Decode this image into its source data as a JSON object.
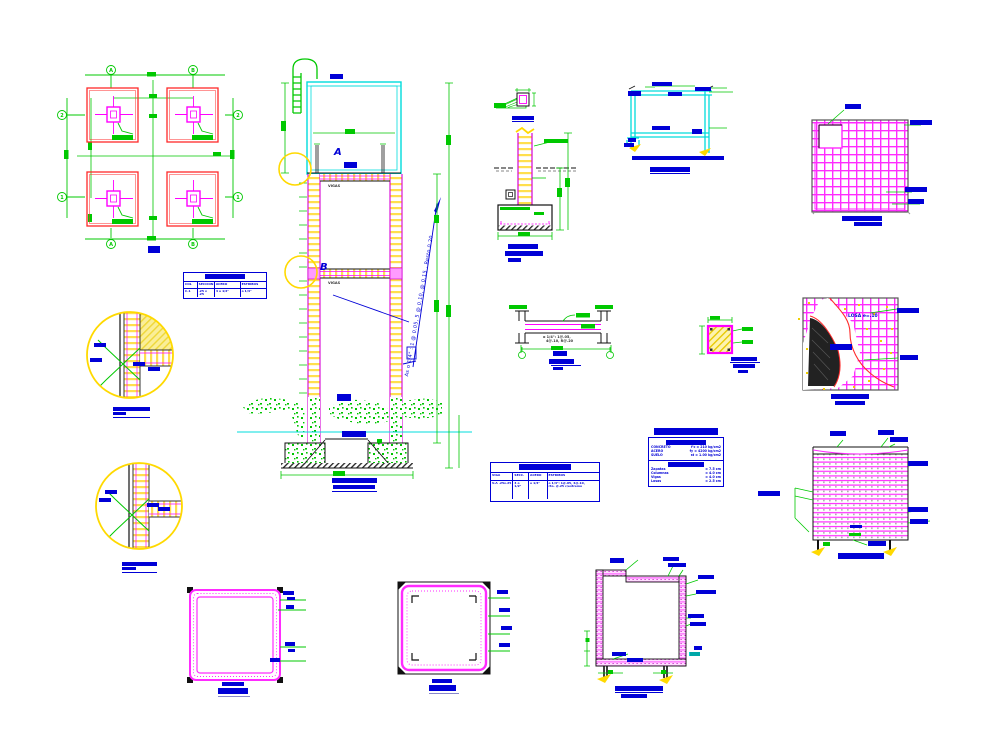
{
  "colors": {
    "green": "#00c800",
    "magenta": "#ff00ff",
    "red": "#ff2a2a",
    "cyan": "#00dcdc",
    "yellow": "#ffd900",
    "blue": "#0000d6",
    "black": "#1a1a1a"
  },
  "fplan": {
    "title": "PLANTA",
    "axis_a": "A",
    "axis_b": "B",
    "axis_1": "1",
    "axis_2": "2"
  },
  "col_table": {
    "header": "CUADRO DE COLUMNAS",
    "c1": "COL",
    "c2": "SECCION",
    "c3": "ACERO",
    "c4": "ESTRIBOS",
    "r1": "C-1",
    "r2": ".25 x .25",
    "r3": "4 o 1/2\"",
    "r4": "o 1/4\""
  },
  "beam_table": {
    "header": "CUADRO DE VIGAS",
    "c1": "VIGA",
    "c2": "SECC.",
    "c3": "ACERO",
    "c4": "ESTRIBOS",
    "r1": "V-A .25x.25",
    "r2": "4 o 1/2\"",
    "r3": "o 1/4\"",
    "r4a": "o 1/4\": 1@.05, 4@.10,",
    "r4b": "rto. @.25 c/extremo"
  },
  "specs": {
    "title": "ESPECIFICACIONES",
    "s1": "CONCRETO",
    "r1l": "CONCRETO",
    "r1r": "f'c = 210 kg/cm2",
    "r2l": "ACERO",
    "r2r": "fy = 4200 kg/cm2",
    "r3l": "SUELO",
    "r3r": "st = 1.00 kg/cm2",
    "s2": "RECUBRIM.",
    "r4l": "Zapatas",
    "r4r": "= 7.5 cm",
    "r5l": "Columnas",
    "r5r": "= 4.0 cm",
    "r6l": "Vigas",
    "r6r": "= 4.0 cm",
    "r7l": "Losas",
    "r7r": "= 2.5 cm"
  },
  "elev": {
    "tank_label": "TAPA",
    "label_a": "A",
    "a_note": "DET. A",
    "vigas_a": "VIGAS",
    "label_b": "B",
    "vigas_b": "VIGAS",
    "note": "As o 1/4\" : 1 @ 0.05, 5 @ 0.10, @ 0.15 , Resto 0.20",
    "ground": "NTN",
    "water": "N.F. -1.20",
    "dim": "1.00",
    "title1": "TANQUE ELEVADO",
    "title2": "ELEVACION ESC. 1/25"
  },
  "circleA": {
    "l1": "V-A",
    "l2": "C-1",
    "l3": "o 1/4\"",
    "l4": "e=.05",
    "title1": "DETALLE  A",
    "title2": "ESC. 1/10"
  },
  "circleB": {
    "l1": "V-A",
    "l2": "C-1",
    "l3": "o 1/4\"",
    "l4": "e=.05",
    "title1": "DETALLE  B",
    "title2": "ESC. 1/10"
  },
  "cd1": {
    "title": "DET. ANCLAJE"
  },
  "cd2": {
    "l1": "o 1/4\" @ .20",
    "title1": "DETALLE DE",
    "title2": "COLUMNA - ZAPATA",
    "title3": "ESC 1/25"
  },
  "tankdet": {
    "l1": "TAPA",
    "l2": "e = 0.05",
    "l3": "o 1/4\"",
    "l4": "LOSA",
    "l5": "e=0.10",
    "l6": "V-A",
    "l7": "NPT",
    "l8": "+0.00",
    "bar": "CORTE TIPICO DE TANQUE APOYADO",
    "title": "DETALLE DE TAPA"
  },
  "slabgrid": {
    "l1": "BOCA",
    "l2": "o 3/8\" @ .20",
    "l3": "o 3/8\"",
    "l4": "@ .20",
    "title1": "PLANTA DE TAPA",
    "title2": "ESC. 1/25"
  },
  "beamdet": {
    "note1": "o 1/4\": 1@.05,",
    "note2": "4@.10, R@.20",
    "l1": "V-A",
    "title1": "DETALLE VIGA",
    "title2": "ESC."
  },
  "beamsec": {
    "title1": "SECCION V-A",
    "title2": "ESC. 1/10",
    "title3": "-"
  },
  "slabcut": {
    "l1": "LOSA e=.10",
    "l2": "o 1/4\"",
    "l3": "o 3/8\" @ .20",
    "l4": "o 3/8\" @ .20",
    "title1": "PLANTA DE FONDO",
    "title2": "ESC. 1/25"
  },
  "wallelev": {
    "t1": "TAPA",
    "t2": "o 1/4\"",
    "t3": "@ .20",
    "r1": "o 1/4\" @ .15",
    "r2": "o 1/4\"",
    "r3": "@ .15",
    "left": "o 1/4\"",
    "inner": "e=.05",
    "bottom": "V-A",
    "title": "ELEVACION DE TANQUE"
  },
  "sq1": {
    "s1a": "o 1/4\"",
    "s1b": "@.15",
    "s2a": "o 1/4\"",
    "s2b": "@.15",
    "s3a": "o 1/4\"",
    "s3b": "@.15",
    "s4": "e=.05",
    "title1": "PLANTA",
    "title2": "TAPA TANQUE"
  },
  "sq2": {
    "s1": "o 1/4\"",
    "s2": "@ .15",
    "s3": "o 1/4\"",
    "s4": "@ .15",
    "title1": "PLANTA",
    "title2": "CUERPO TANQUE"
  },
  "tanksec": {
    "t1": "TAPA",
    "t2": "o 1/4\"",
    "t3": "@ .15",
    "r1": "o 1/4\"",
    "r2": "@ .15",
    "r3": "o 1/4\"",
    "r4": "@ .15",
    "i1": "FONDO",
    "i2": "e=.07",
    "rb1": "NPT",
    "rb2": "+.00",
    "title1": "CORTE DE TANQUE DE AGUA",
    "title2": "ESC. 1/20"
  }
}
